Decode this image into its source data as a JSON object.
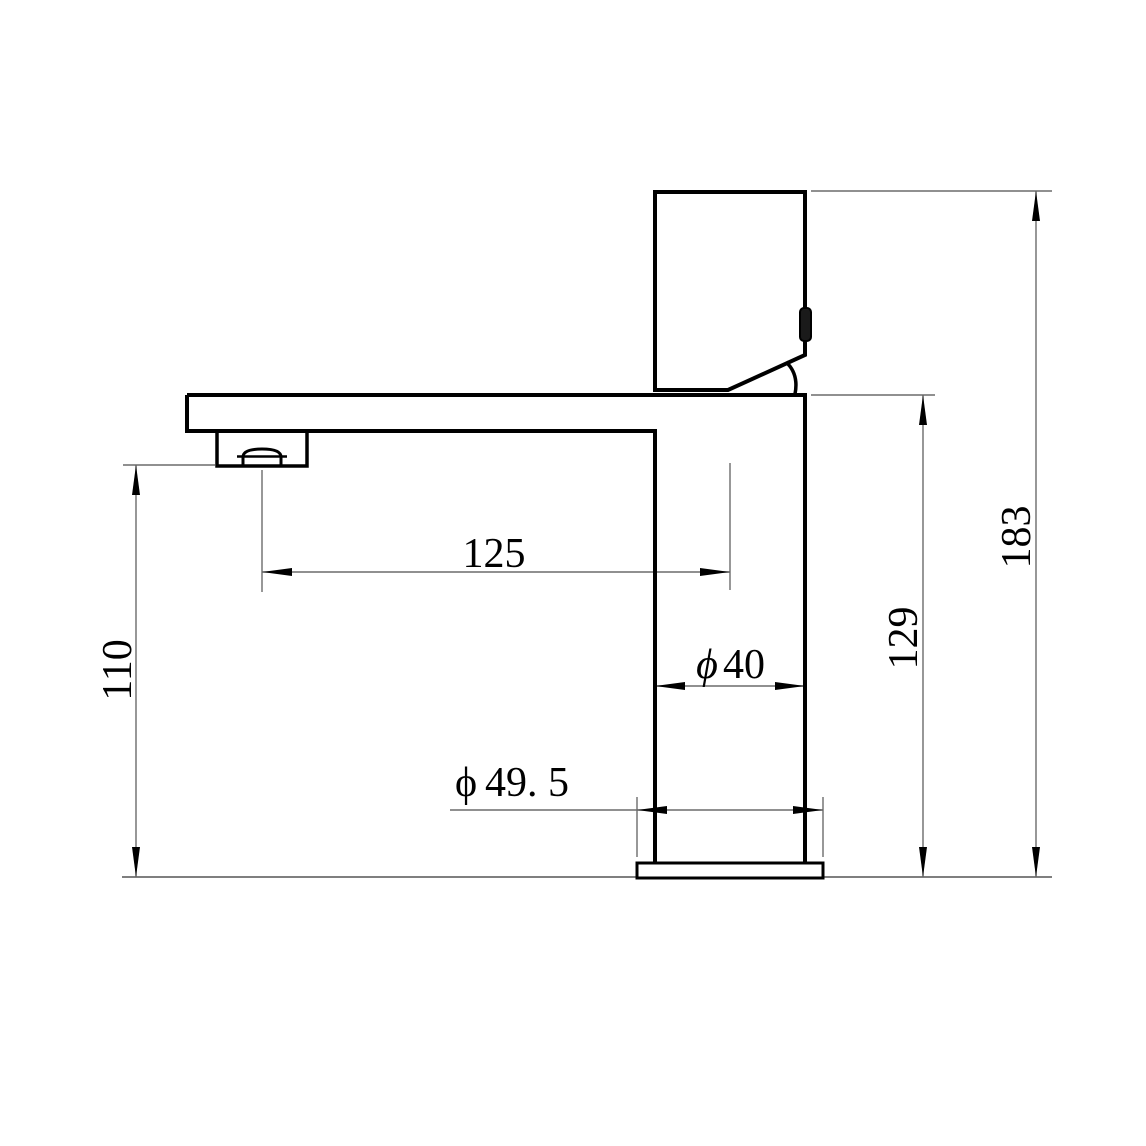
{
  "drawing": {
    "subject": "single-lever basin faucet, side elevation technical drawing",
    "labels": {
      "reach": "125",
      "outlet_height": "110",
      "overall_height": "183",
      "body_top_height": "129",
      "body_dia_symbol": "ϕ",
      "body_dia_value": "40",
      "base_dia_symbol": "ϕ",
      "base_dia_value": "49. 5"
    },
    "colors": {
      "outline": "#000000",
      "dimension_line": "#6b6b6b",
      "ground_line": "#555555",
      "text": "#000000",
      "background": "#ffffff"
    }
  }
}
